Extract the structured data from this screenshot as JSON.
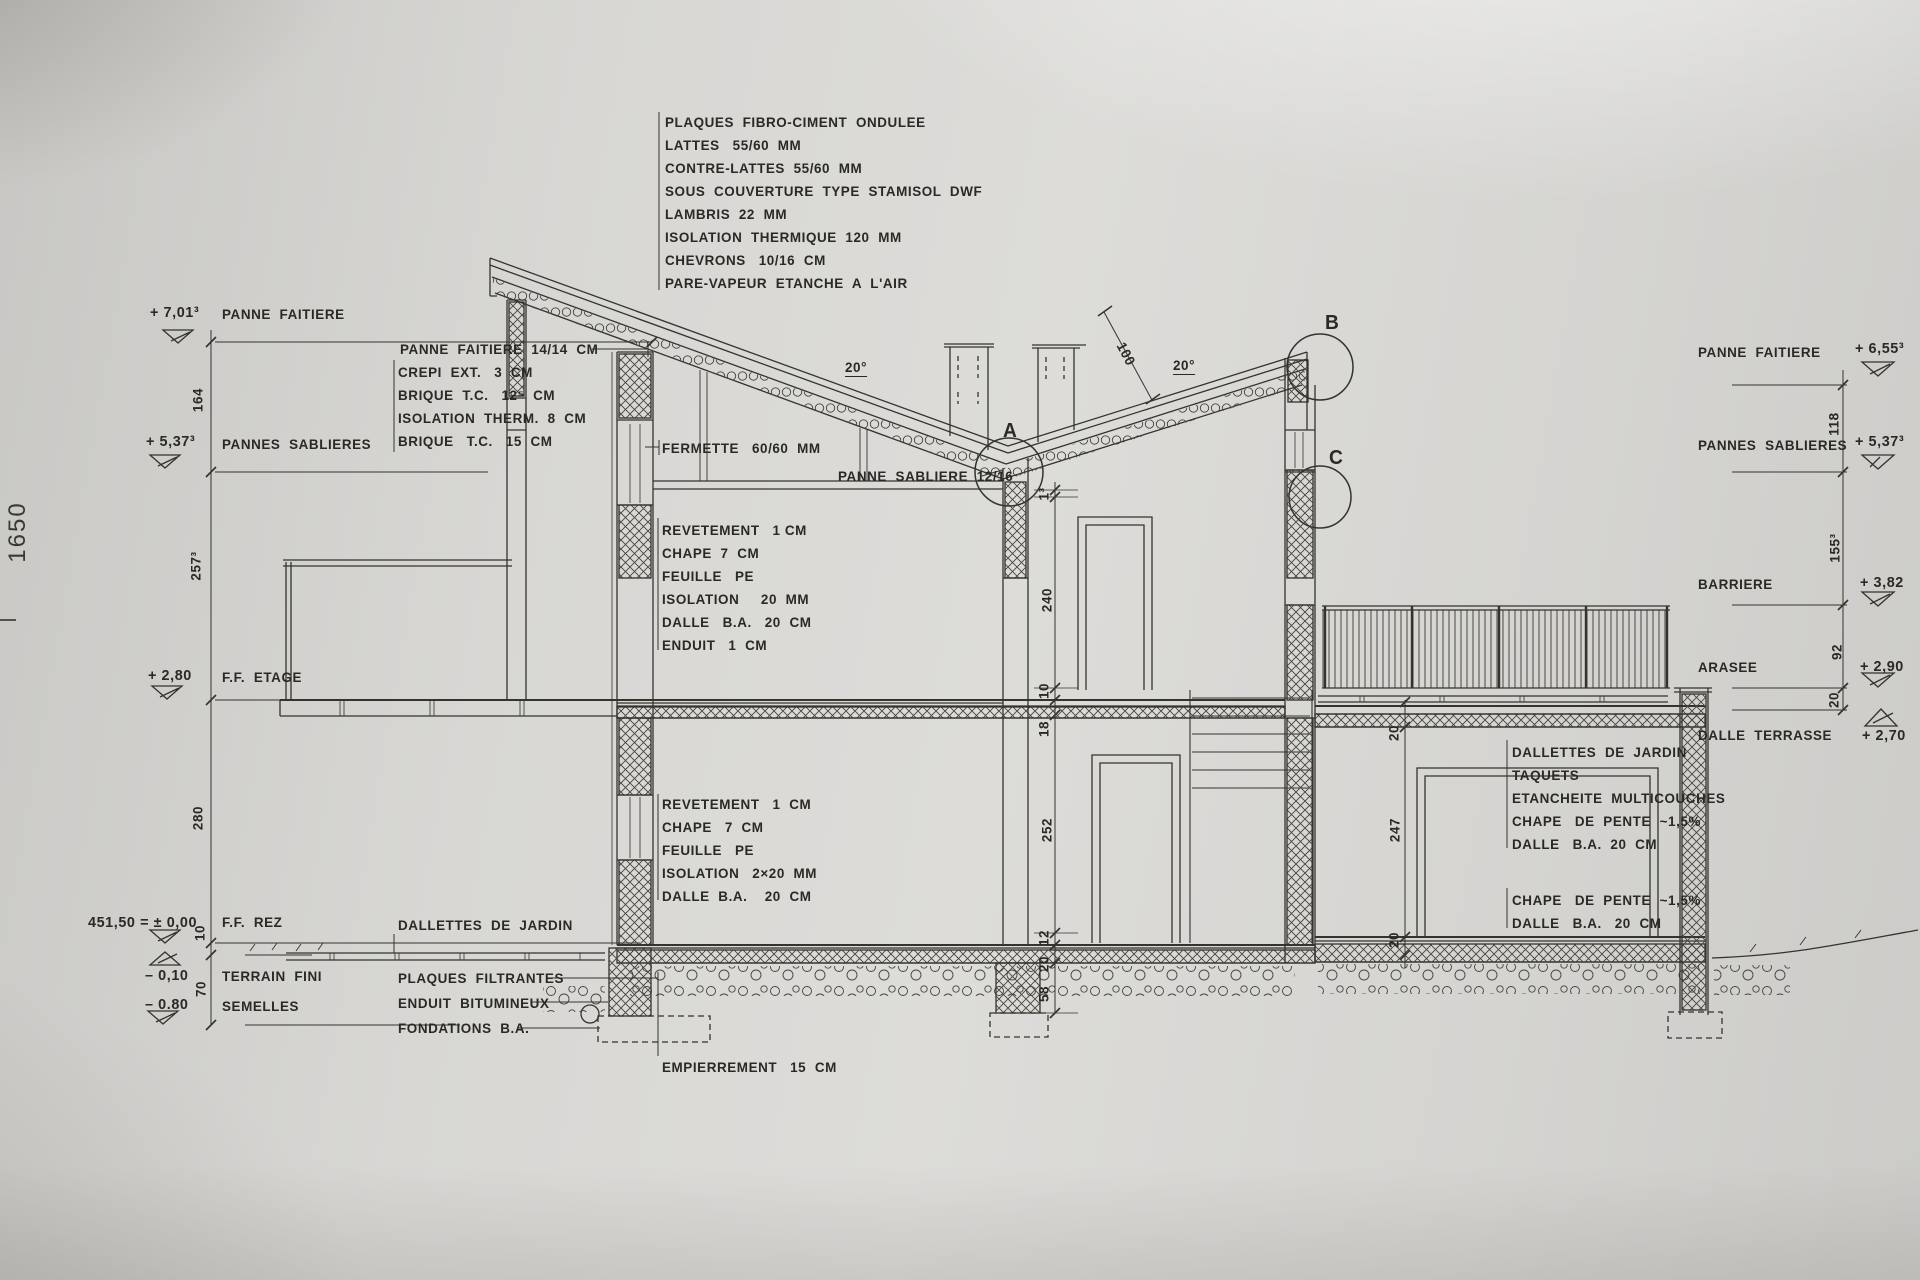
{
  "sheet": {
    "number": "1650"
  },
  "roof_assembly": {
    "lines": [
      "PLAQUES  FIBRO-CIMENT  ONDULEE",
      "LATTES   55/60  MM",
      "CONTRE-LATTES  55/60  MM",
      "SOUS  COUVERTURE  TYPE  STAMISOL  DWF",
      "LAMBRIS  22  MM",
      "ISOLATION  THERMIQUE  120  MM",
      "CHEVRONS   10/16  CM",
      "PARE-VAPEUR  ETANCHE  A  L'AIR"
    ]
  },
  "wall_assembly": {
    "title": "PANNE  FAITIERE  14/14  CM",
    "lines": [
      "CREPI  EXT.   3  CM",
      "BRIQUE  T.C.   12⁵  CM",
      "ISOLATION  THERM.  8  CM",
      "BRIQUE   T.C.   15  CM"
    ]
  },
  "roof_labels": {
    "fermette": "FERMETTE   60/60  MM",
    "panne_sabliere": "PANNE  SABLIERE  12/16",
    "angle_left": "20°",
    "angle_right": "20°",
    "dim_100": "100",
    "detail_a": "A",
    "detail_b": "B",
    "detail_c": "C"
  },
  "etage_floor": {
    "lines": [
      "REVETEMENT   1 CM",
      "CHAPE  7  CM",
      "FEUILLE   PE",
      "ISOLATION     20  MM",
      "DALLE   B.A.   20  CM",
      "ENDUIT   1  CM"
    ]
  },
  "rez_floor": {
    "lines": [
      "REVETEMENT   1  CM",
      "CHAPE   7  CM",
      "FEUILLE   PE",
      "ISOLATION   2×20  MM",
      "DALLE  B.A.    20  CM"
    ]
  },
  "ground_labels": {
    "dallettes": "DALLETTES  DE  JARDIN",
    "plaques": "PLAQUES  FILTRANTES",
    "enduit": "ENDUIT  BITUMINEUX",
    "fondations": "FONDATIONS  B.A.",
    "empierrement": "EMPIERREMENT   15  CM"
  },
  "terrace_assembly": {
    "lines": [
      "DALLETTES  DE  JARDIN",
      "TAQUETS",
      "ETANCHEITE  MULTICOUCHES",
      "CHAPE   DE  PENTE  ~1,5%",
      "DALLE   B.A.  20  CM"
    ]
  },
  "terrace_slab": {
    "lines": [
      "CHAPE   DE  PENTE  ~1,5%",
      "DALLE   B.A.   20  CM"
    ]
  },
  "levels_left": [
    {
      "value": "+ 7,01³",
      "label": "PANNE  FAITIERE"
    },
    {
      "value": "+ 5,37³",
      "label": "PANNES  SABLIERES"
    },
    {
      "value": "+ 2,80",
      "label": "F.F.  ETAGE"
    },
    {
      "value": "451,50 = ± 0,00",
      "label": "F.F.  REZ"
    },
    {
      "value": "– 0,10",
      "label": "TERRAIN  FINI"
    },
    {
      "value": "– 0.80",
      "label": "SEMELLES"
    }
  ],
  "levels_right": [
    {
      "label": "PANNE  FAITIERE",
      "value": "+ 6,55³"
    },
    {
      "label": "PANNES  SABLIERES",
      "value": "+ 5,37³"
    },
    {
      "label": "BARRIERE",
      "value": "+ 3,82"
    },
    {
      "label": "ARASEE",
      "value": "+ 2,90"
    },
    {
      "label": "DALLE  TERRASSE",
      "value": "+ 2,70"
    }
  ],
  "dims_left": [
    "164",
    "257³",
    "280",
    "10",
    "70"
  ],
  "dims_center": [
    "1³",
    "240",
    "10",
    "18",
    "252",
    "12",
    "20",
    "58"
  ],
  "dims_annex": [
    "20",
    "247",
    "20"
  ],
  "dims_right": [
    "118",
    "155³",
    "92",
    "20"
  ],
  "line_color": "#35332c"
}
